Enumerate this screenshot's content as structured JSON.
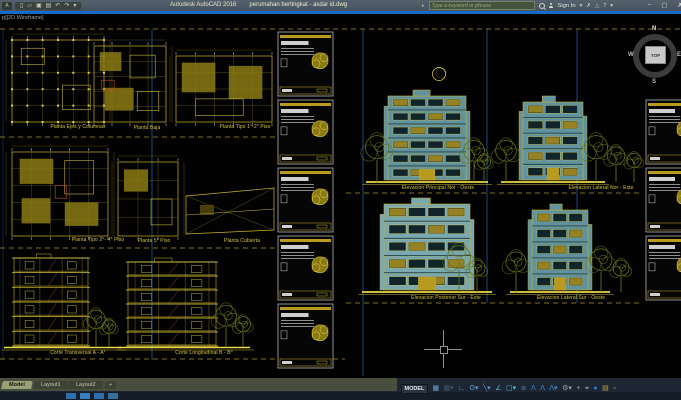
{
  "title_bar": {
    "app_title": "Autodesk AutoCAD 2016",
    "document_title": "perumahan bertingkat - asdar id.dwg",
    "qat": {
      "app": "A",
      "new": "▯",
      "open": "▱",
      "save": "▣",
      "plot": "▤",
      "undo": "↶",
      "redo": "↷",
      "caret": "▾"
    },
    "infocenter": {
      "toggle": "▸",
      "search_placeholder": "Type a keyword or phrase",
      "sign_in": "Sign In",
      "caret": "▾",
      "exchange": "✗",
      "share": "△",
      "help": "?"
    },
    "window": {
      "minimize": "–",
      "maximize": "▢",
      "close": "✗"
    }
  },
  "canvas": {
    "viewport_label": "p][2D Wireframe]",
    "viewcube": {
      "top": "TOP",
      "north": "N",
      "west": "W",
      "south": "S",
      "east": "E"
    },
    "labels": [
      "Planta Ejes y Columnas",
      "Planta Baja",
      "Planta Tipo 1°-2° Piso",
      "Planta Tipo 2°- 4° Piso",
      "Planta 5° Piso",
      "Planta Cubierta",
      "Corte Transversal A - A°",
      "Corte Longitudinal B - B°",
      "Elevacion Principal Nor - Oeste",
      "Elevacion Lateral Nor - Este",
      "Elevacion Posterior Sur - Este",
      "Elevacion Lateral Sur - Oeste"
    ]
  },
  "bottom": {
    "tabs": [
      "Model",
      "Layout1",
      "Layout2",
      "+"
    ],
    "status": {
      "model_button": "MODEL",
      "icons": [
        "▦",
        "▦▾",
        "∟",
        "ʘ▾",
        "╲▾",
        "∠",
        "▢▾",
        "≣",
        "Λ",
        "Λ",
        "Λ▾",
        "⚙▾",
        "+",
        "⌖",
        "●",
        "▤",
        "▫"
      ]
    }
  },
  "colors": {
    "cad_yellow": "#c9b227",
    "cad_teal": "#60939f",
    "guide_blue": "#17497c",
    "status_icon_blue": "#5b9bd5"
  }
}
